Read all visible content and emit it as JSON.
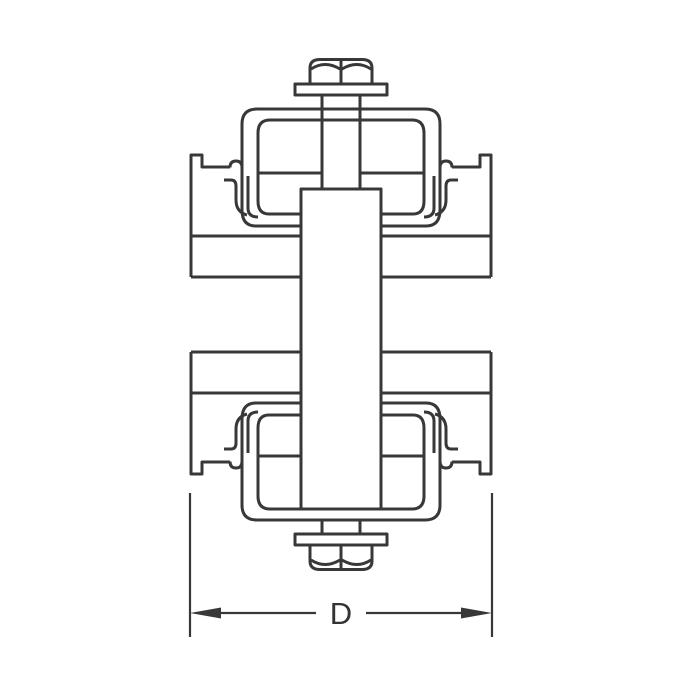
{
  "page": {
    "background_color": "#ffffff",
    "description": "Technical line drawing of a strut channel clamp assembly with bolt, brackets, spacer block and nut"
  },
  "drawing": {
    "line_color": "#383838",
    "dimension": {
      "label": "D"
    },
    "parts": [
      "hex bolt head",
      "top washer",
      "bolt shaft",
      "top clamp bracket",
      "top strut channel",
      "center spacer block",
      "bottom strut channel",
      "bottom clamp bracket",
      "bottom washer",
      "hex nut",
      "width dimension D"
    ]
  }
}
